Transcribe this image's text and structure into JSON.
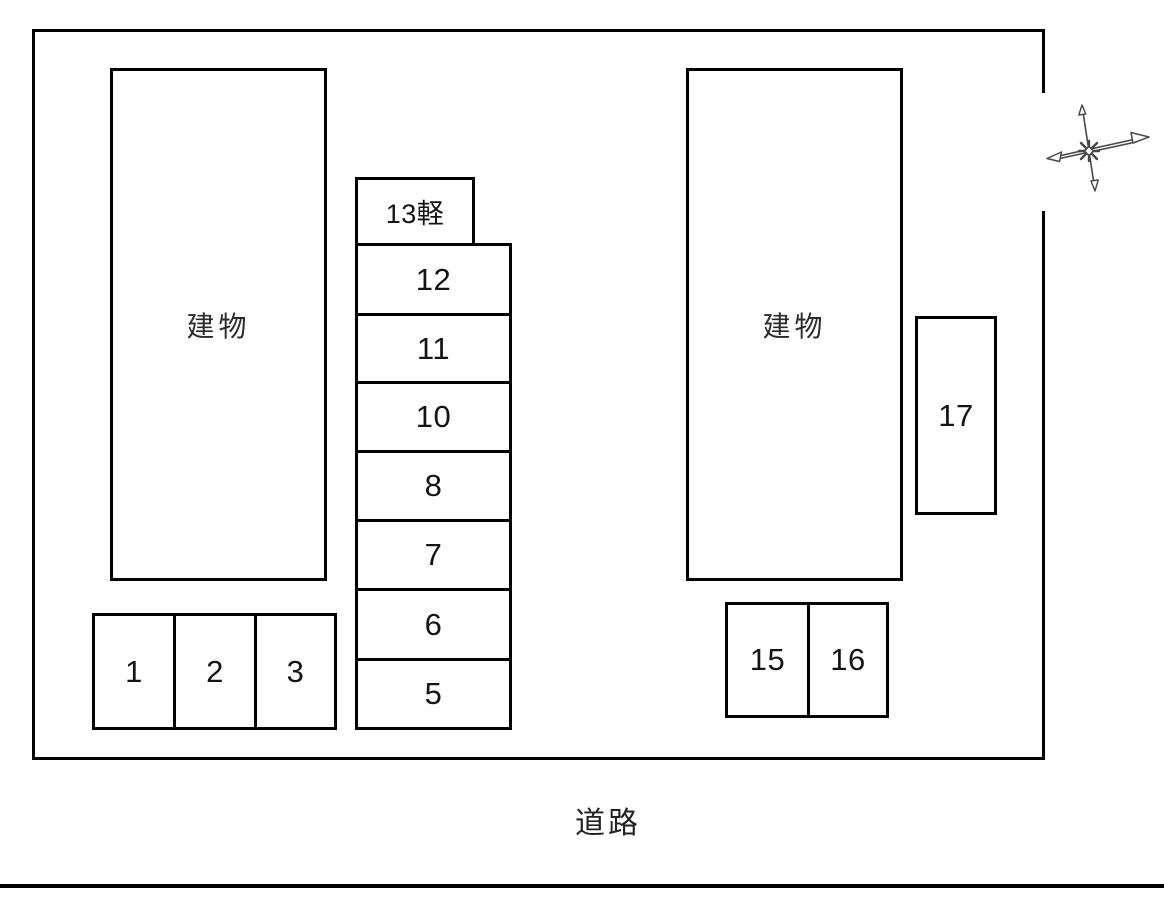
{
  "diagram": {
    "type": "parking-site-plan",
    "buildings": [
      {
        "label": "建物"
      },
      {
        "label": "建物"
      }
    ],
    "spaces": {
      "left_row": [
        "1",
        "2",
        "3"
      ],
      "center_column": [
        "13軽",
        "12",
        "11",
        "10",
        "8",
        "7",
        "6",
        "5"
      ],
      "right_pair": [
        "15",
        "16"
      ],
      "right_single": [
        "17"
      ]
    },
    "road_label": "道路",
    "icons": {
      "compass": "compass-rose"
    },
    "colors": {
      "line": "#000000",
      "background": "#ffffff",
      "compass": "#474747"
    }
  }
}
